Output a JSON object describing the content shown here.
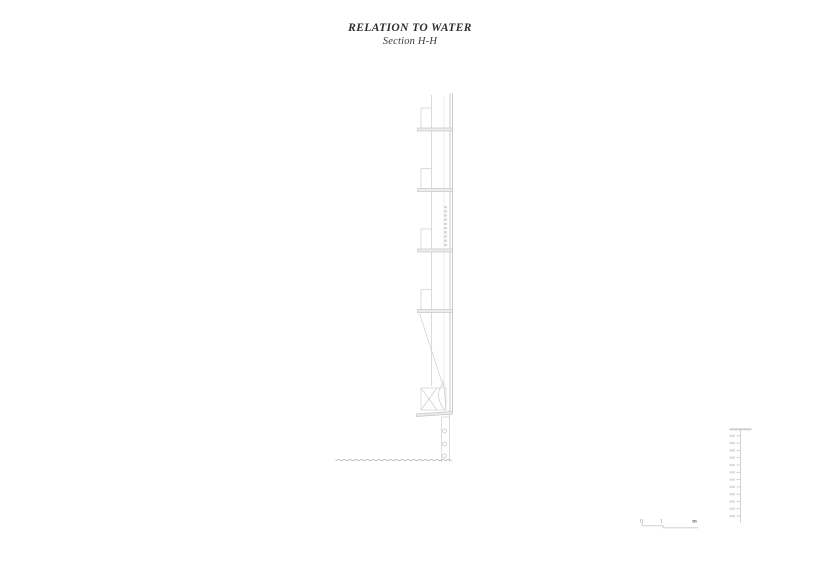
{
  "header": {
    "title": "RELATION TO WATER",
    "subtitle": "Section H-H"
  },
  "scale_bar": {
    "zero": "0",
    "one": "1",
    "unit": "m"
  },
  "elevation_ruler": {
    "tick_count": 13,
    "labels_legible": false
  },
  "drawing": {
    "balcony_levels": 4
  },
  "colors": {
    "background": "#ffffff",
    "title_text": "#2e2e2e",
    "line_faint": "#e4e4e4",
    "line_light": "#d2d2d2",
    "line_mid": "#bdbdbd",
    "slab_fill": "#ececec",
    "water_line": "#b5b5b5",
    "ruler_line": "#c9c9c9"
  }
}
